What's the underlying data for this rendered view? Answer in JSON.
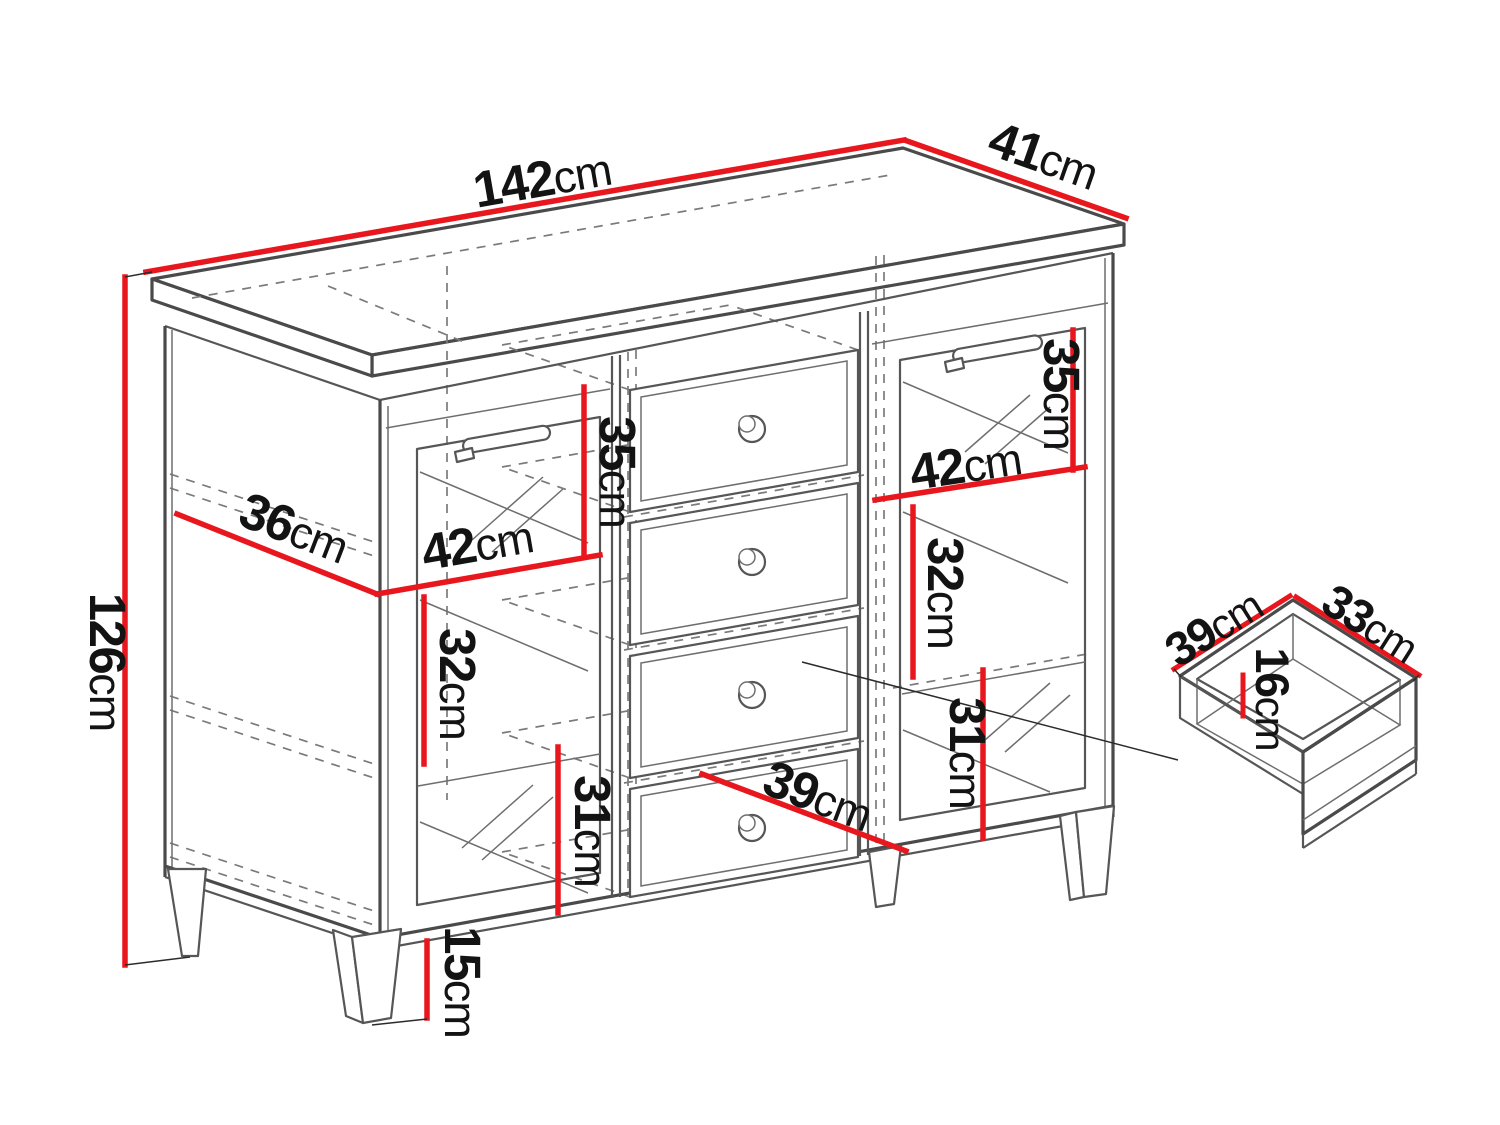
{
  "figure": {
    "kind": "furniture dimension diagram",
    "piece": "sideboard with two glass doors and four drawers, plus detached drawer box detail",
    "unit": "cm"
  },
  "colors": {
    "background": "#ffffff",
    "outline": "#4a4a4a",
    "hidden_line": "#7a7a7a",
    "dimension_line": "#e8171d",
    "text": "#131313"
  },
  "labels": [
    {
      "num": "142",
      "unit": "cm"
    },
    {
      "num": "41",
      "unit": "cm"
    },
    {
      "num": "126",
      "unit": "cm"
    },
    {
      "num": "36",
      "unit": "cm"
    },
    {
      "num": "35",
      "unit": "cm"
    },
    {
      "num": "42",
      "unit": "cm"
    },
    {
      "num": "32",
      "unit": "cm"
    },
    {
      "num": "31",
      "unit": "cm"
    },
    {
      "num": "15",
      "unit": "cm"
    },
    {
      "num": "39",
      "unit": "cm"
    },
    {
      "num": "35",
      "unit": "cm"
    },
    {
      "num": "42",
      "unit": "cm"
    },
    {
      "num": "32",
      "unit": "cm"
    },
    {
      "num": "31",
      "unit": "cm"
    },
    {
      "num": "39",
      "unit": "cm"
    },
    {
      "num": "33",
      "unit": "cm"
    },
    {
      "num": "16",
      "unit": "cm"
    }
  ]
}
